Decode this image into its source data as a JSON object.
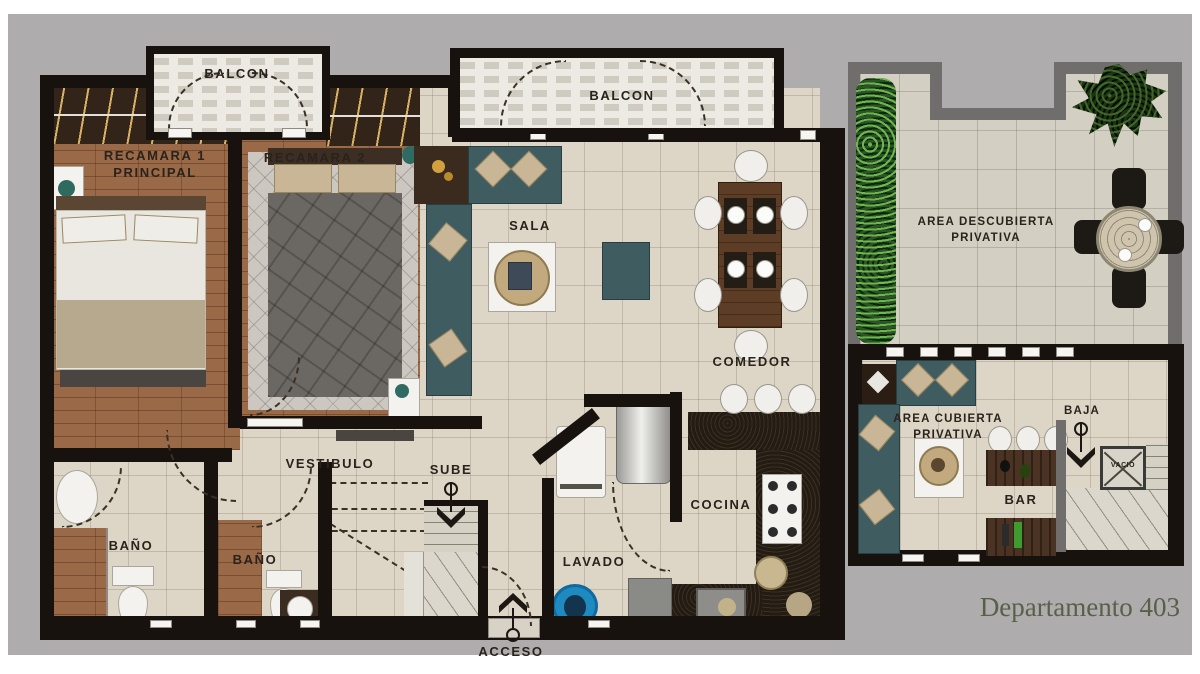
{
  "title": "Departamento 403",
  "labels": {
    "balcon_small": "BALCON",
    "balcon_large": "BALCON",
    "recamara1_l1": "RECAMARA 1",
    "recamara1_l2": "PRINCIPAL",
    "recamara2": "RECAMARA 2",
    "sala": "SALA",
    "comedor": "COMEDOR",
    "vestibulo": "VESTIBULO",
    "sube": "SUBE",
    "bano1": "BAÑO",
    "bano2": "BAÑO",
    "cocina": "COCINA",
    "lavado": "LAVADO",
    "acceso": "ACCESO",
    "area_descubierta_l1": "AREA DESCUBIERTA",
    "area_descubierta_l2": "PRIVATIVA",
    "area_cubierta_l1": "AREA CUBIERTA",
    "area_cubierta_l2": "PRIVATIVA",
    "baja": "BAJA",
    "vacio": "VACIO",
    "bar": "BAR"
  },
  "colors": {
    "background": "#aeacad",
    "wall": "#17120e",
    "terrace_wall": "#6f6e6c",
    "wood_floor": "#9a6947",
    "tile_floor": "#ddd6c7",
    "sofa": "#3f5c60",
    "hedge": "#2c5426",
    "label_text": "#2a231c",
    "title_text": "#596049"
  }
}
